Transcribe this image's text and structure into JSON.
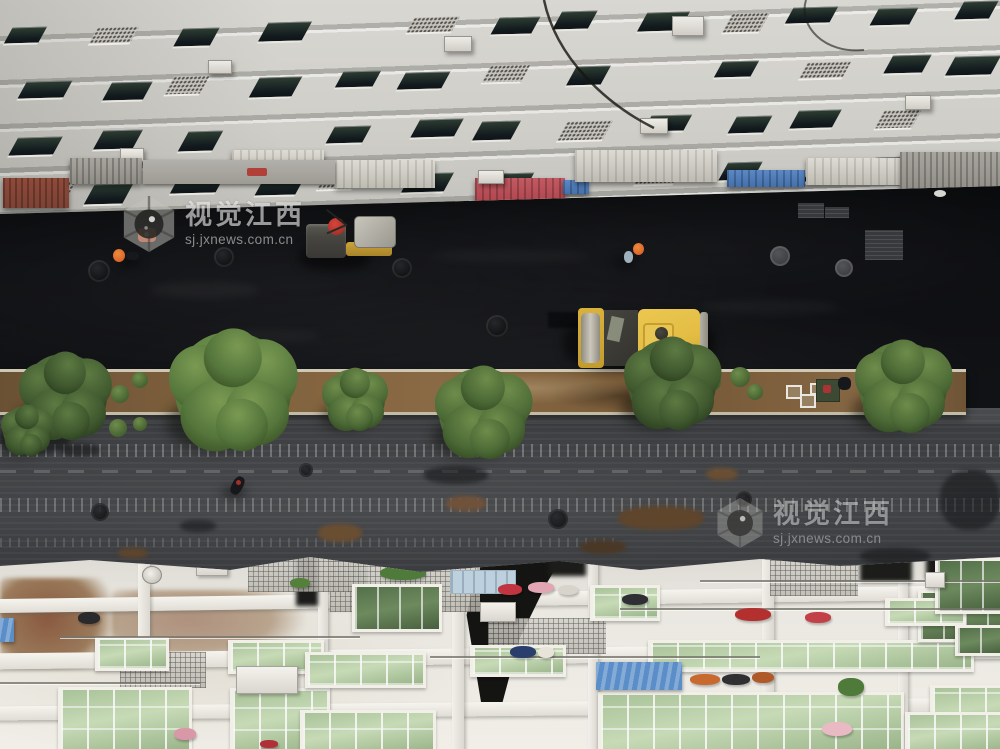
{
  "photo": {
    "watermark": {
      "brand": "视觉江西",
      "url": "sj.jxnews.com.cn"
    },
    "palette": {
      "fresh_asphalt": "#0c0d0f",
      "milled_asphalt": "#3e4043",
      "facade": "#d8d7d2",
      "rooftop": "#eae8e1",
      "skylight": "#c6dab6",
      "soil": "#7d5f3c",
      "curb": "#cfc8b4",
      "tree": "#4e6a38",
      "roller_yellow": "#e3bd44",
      "drum_gray": "#a8a49a",
      "worker_orange": "#d9662a",
      "awning_red": "#b84a52",
      "awning_blue": "#4d7dbd",
      "rust": "#8a5a40"
    }
  }
}
